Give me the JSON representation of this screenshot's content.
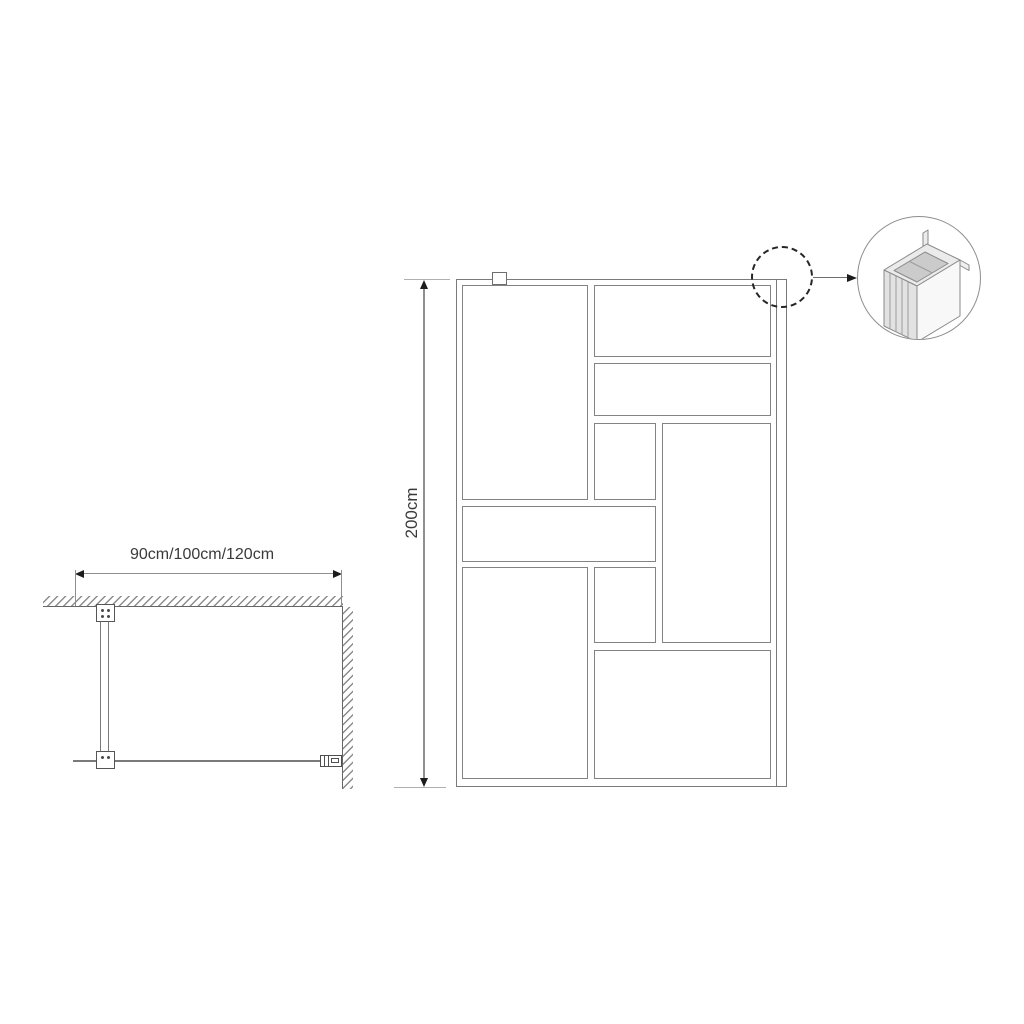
{
  "plan_view": {
    "width_label": "90cm/100cm/120cm"
  },
  "front_view": {
    "height_label": "200cm"
  },
  "colors": {
    "structure_line": "#7a7a7a",
    "dimension_line": "#8f8f8f",
    "text": "#3a3a3a",
    "hatch": "#8c8c8c",
    "arrowhead": "#1c1c1c",
    "background": "#ffffff"
  }
}
